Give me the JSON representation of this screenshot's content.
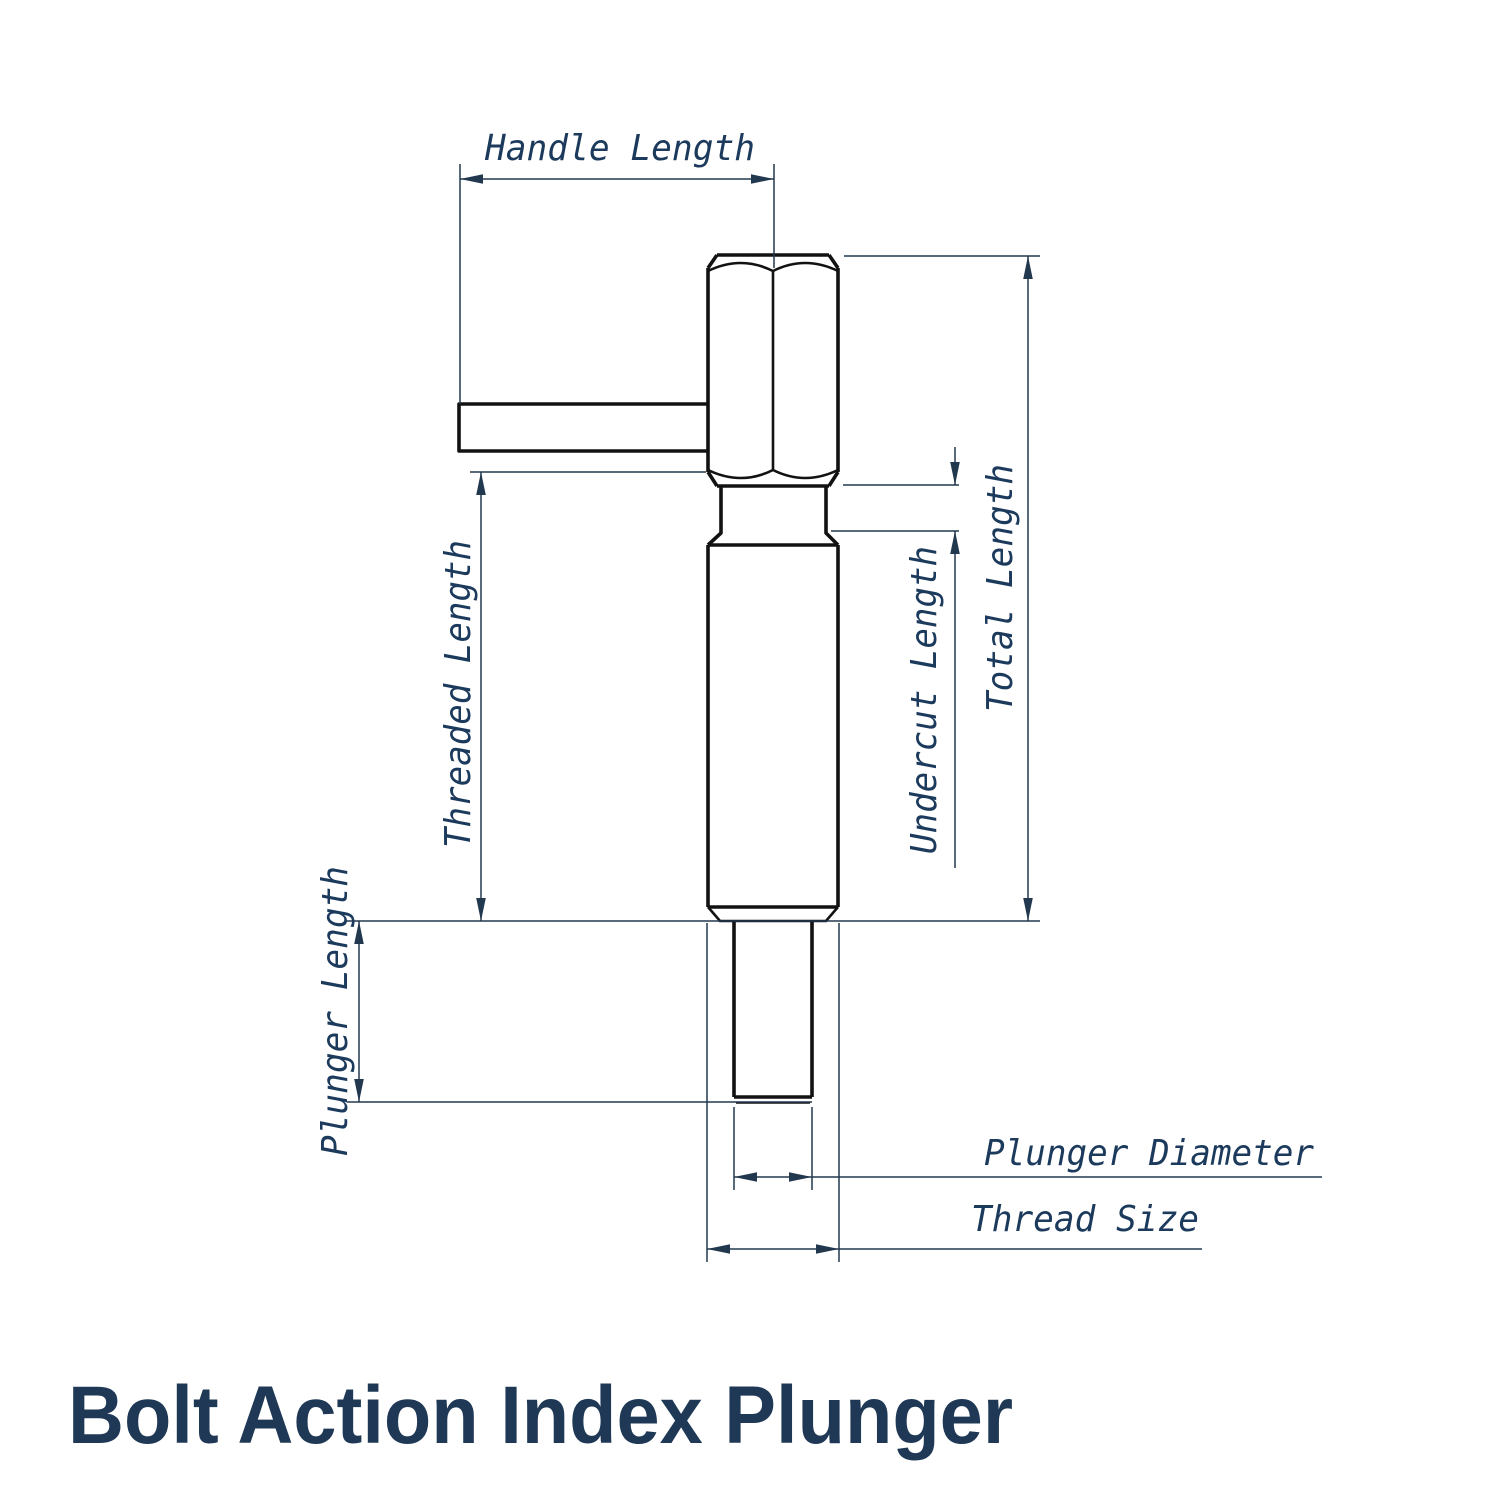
{
  "title": {
    "text": "Bolt Action Index Plunger"
  },
  "labels": {
    "handle_length": "Handle Length",
    "threaded_length": "Threaded Length",
    "plunger_length": "Plunger Length",
    "undercut_length": "Undercut Length",
    "total_length": "Total Length",
    "plunger_diameter": "Plunger Diameter",
    "thread_size": "Thread Size"
  },
  "colors": {
    "background": "#ffffff",
    "outline": "#121212",
    "dimension": "#22384f",
    "label_text": "#1c3a5c",
    "title_text": "#1f3855"
  }
}
